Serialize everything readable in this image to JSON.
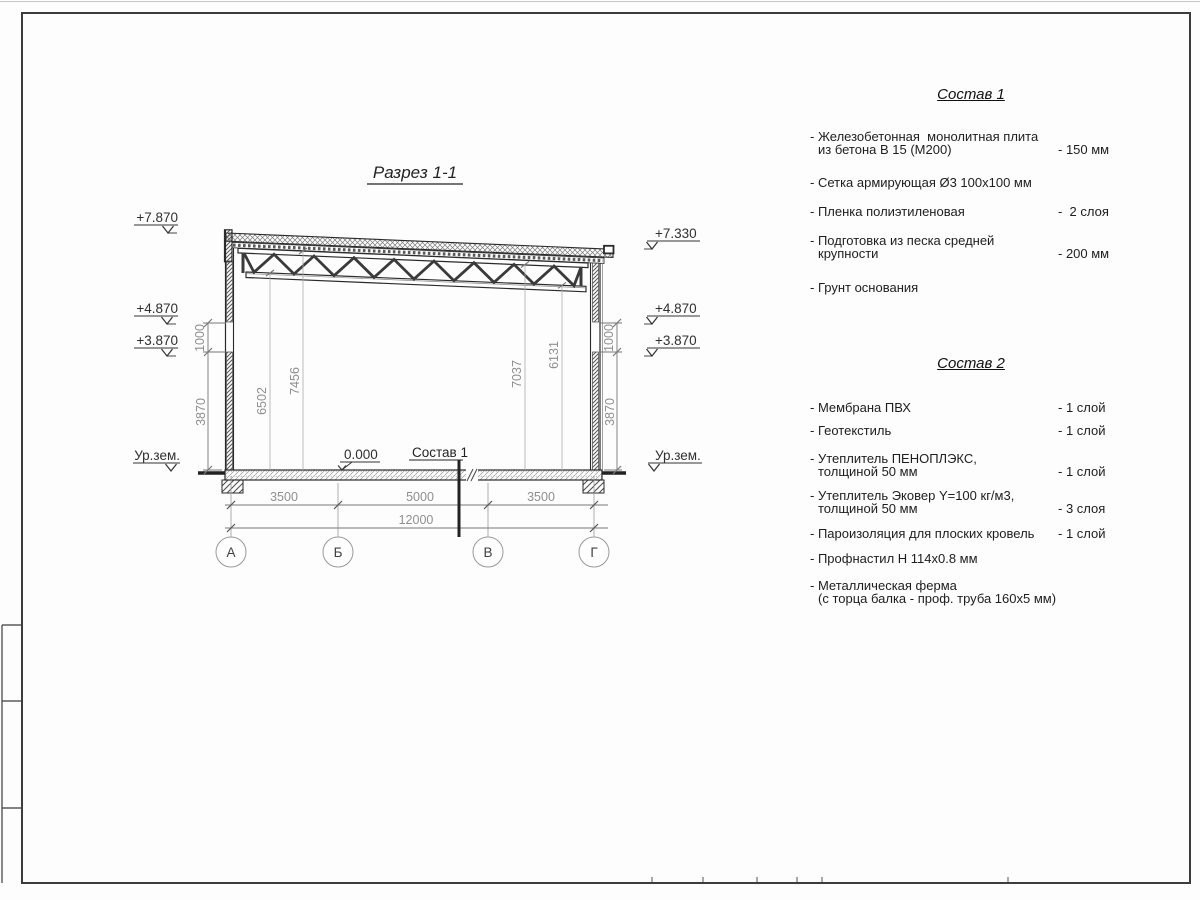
{
  "section": {
    "title": "Разрез 1-1",
    "elev": {
      "l_roof": "+7.870",
      "r_roof": "+7.330",
      "l_487": "+4.870",
      "l_387": "+3.870",
      "r_487": "+4.870",
      "r_387": "+3.870",
      "l_ground": "Ур.зем.",
      "r_ground": "Ур.зем.",
      "zero": "0.000",
      "floor_ref": "Состав 1"
    },
    "dim": {
      "l1000": "1000",
      "l3870": "3870",
      "r1000": "1000",
      "r3870": "3870",
      "h6502": "6502",
      "h7456": "7456",
      "h7037": "7037",
      "h6131": "6131",
      "b3500a": "3500",
      "b5000": "5000",
      "b3500b": "3500",
      "b12000": "12000"
    },
    "axes": [
      "А",
      "Б",
      "В",
      "Г"
    ]
  },
  "composition1": {
    "heading": "Состав 1",
    "items": [
      {
        "line1": "- Железобетонная  монолитная плита",
        "line2": "из бетона В 15 (М200)",
        "value": "- 150 мм"
      },
      {
        "line1": "- Сетка армирующая Ø3 100х100 мм",
        "line2": "",
        "value": ""
      },
      {
        "line1": "- Пленка полиэтиленовая",
        "line2": "",
        "value": "-  2 слоя"
      },
      {
        "line1": "- Подготовка из песка средней",
        "line2": "крупности",
        "value": "- 200 мм"
      },
      {
        "line1": "- Грунт основания",
        "line2": "",
        "value": ""
      }
    ]
  },
  "composition2": {
    "heading": "Состав 2",
    "items": [
      {
        "line1": "- Мембрана ПВХ",
        "line2": "",
        "value": "- 1 слой"
      },
      {
        "line1": "- Геотекстиль",
        "line2": "",
        "value": "- 1 слой"
      },
      {
        "line1": "- Утеплитель ПЕНОПЛЭКС,",
        "line2": "толщиной 50 мм",
        "value": "- 1 слой"
      },
      {
        "line1": "- Утеплитель Эковер Y=100 кг/м3,",
        "line2": "толщиной 50 мм",
        "value": "- 3 слоя"
      },
      {
        "line1": "- Пароизоляция для плоских кровель",
        "line2": "",
        "value": "- 1 слой"
      },
      {
        "line1": "- Профнастил Н 114х0.8 мм",
        "line2": "",
        "value": ""
      },
      {
        "line1": "- Металлическая ферма",
        "line2": "(с торца балка - проф. труба 160х5 мм)",
        "value": ""
      }
    ]
  },
  "colors": {
    "line_dark": "#2a2a2a",
    "line_gray": "#777777",
    "dim_text": "#8f8f8f",
    "paper": "#fdfdfd"
  }
}
